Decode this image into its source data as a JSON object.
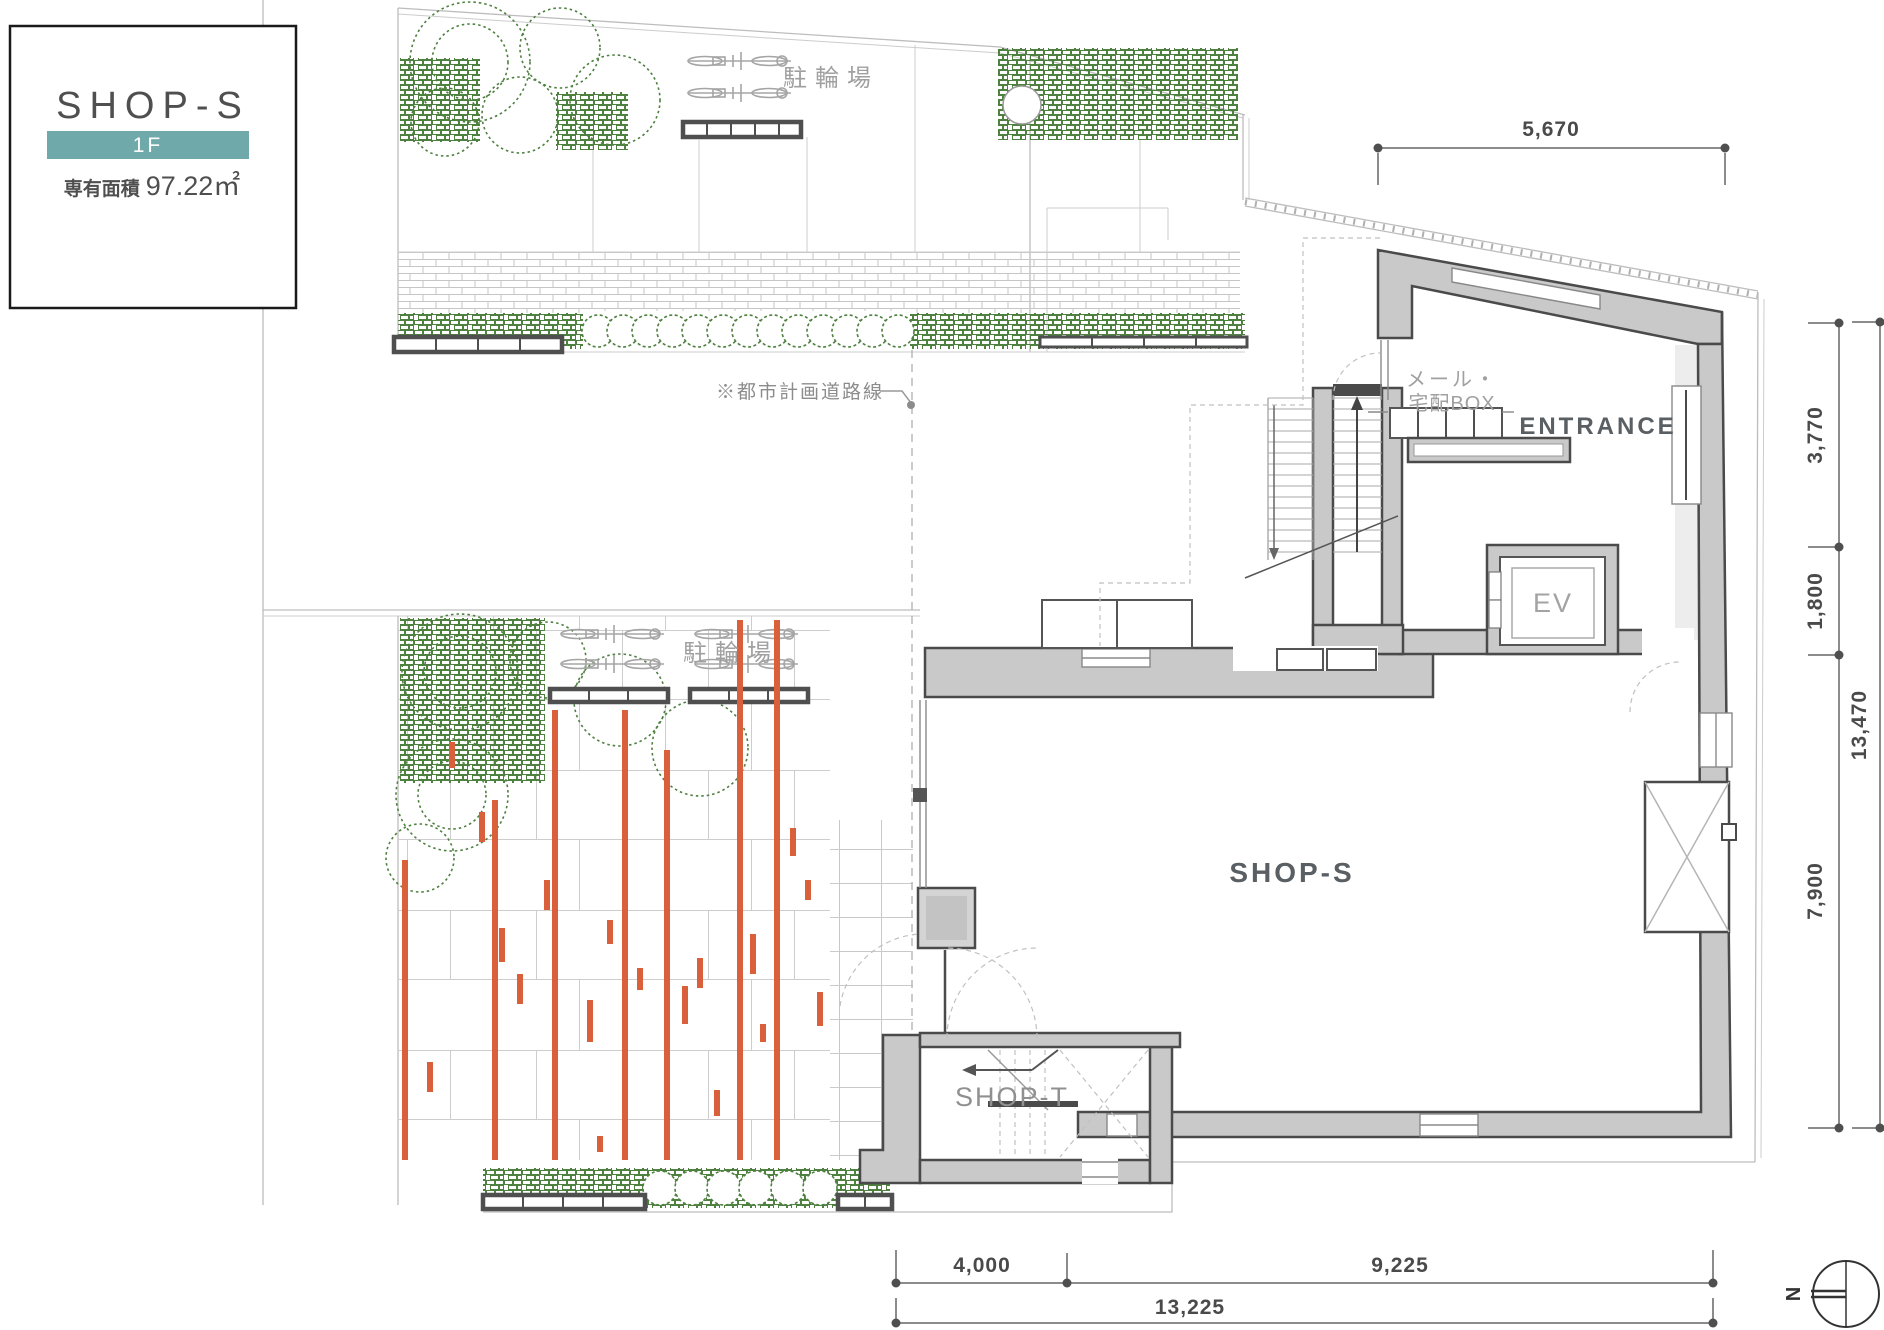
{
  "card": {
    "title": "SHOP-S",
    "floor": "1F",
    "area_label": "専有面積",
    "area_value": "97.22㎡"
  },
  "labels": {
    "bicycle_parking_top": "駐輪場",
    "bicycle_parking_lower": "駐輪場",
    "planned_road": "※都市計画道路線",
    "mail_box_line1": "メール・",
    "mail_box_line2": "宅配BOX",
    "entrance": "ENTRANCE",
    "elevator": "EV",
    "shop_s_room": "SHOP-S",
    "shop_t_room": "SHOP-T",
    "north": "N"
  },
  "dimensions": {
    "top": "5,670",
    "right_upper": "3,770",
    "right_middle": "1,800",
    "right_lower": "7,900",
    "right_total": "13,470",
    "bottom_left": "4,000",
    "bottom_right": "9,225",
    "bottom_total": "13,225"
  },
  "colors": {
    "badge_teal": "#6FA9A9",
    "landscape_green": "#4E8040",
    "deck_orange": "#D9603B",
    "wall_gray": "#C9C9C9",
    "wall_edge": "#4A4A4A",
    "label_gray": "#A0A0A0",
    "dim_gray": "#4A4A4A"
  }
}
